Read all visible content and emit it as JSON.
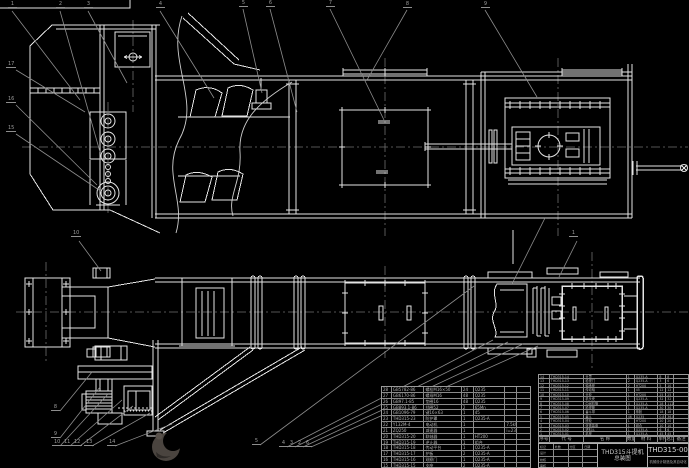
{
  "colors": {
    "background": "#000000",
    "drawing_line": "#e4e4e4",
    "leader_line": "#8d8d8d",
    "centerline": "#6f6f6f",
    "table_text": "#b5b5b5",
    "watermark": "#4a443f"
  },
  "title_block": {
    "title_line1": "THD315斗提机",
    "title_line2": "总装图",
    "drawing_no": "THD315-00",
    "org": "机械设计制造及其自动化",
    "signature_grid": [
      [
        "标记",
        "处数",
        "分区",
        "日期"
      ],
      [
        "设计",
        "",
        "",
        ""
      ],
      [
        "校核",
        "",
        "",
        ""
      ],
      [
        "审核",
        "",
        "",
        ""
      ]
    ]
  },
  "bom_right_header": [
    [
      "序号",
      "代 号",
      "名 称",
      "数量",
      "材 料",
      "单件",
      "总计",
      "备注"
    ]
  ],
  "bom_right_rows": [
    [
      "14",
      "THD315-14",
      "头罩",
      "1",
      "Q235-A",
      "8",
      "8",
      ""
    ],
    [
      "13",
      "THD315-13",
      "检视门",
      "2",
      "Q235-A",
      "3",
      "6",
      ""
    ],
    [
      "12",
      "THD315-12",
      "轴承座",
      "2",
      "HT200",
      "5",
      "10",
      ""
    ],
    [
      "11",
      "THD315-11",
      "传动轴",
      "1",
      "45",
      "12",
      "12",
      ""
    ],
    [
      "10",
      "THD315-10",
      "头轮",
      "1",
      "HT200",
      "25",
      "25",
      ""
    ],
    [
      "9",
      "THD315-09",
      "机头壳",
      "1",
      "Q235-A",
      "32",
      "32",
      ""
    ],
    [
      "8",
      "THD315-08",
      "中间机筒",
      "4",
      "Q235-A",
      "28",
      "112",
      ""
    ],
    [
      "7",
      "THD315-07",
      "检视筒",
      "1",
      "Q235-A",
      "30",
      "30",
      ""
    ],
    [
      "6",
      "THD315-06",
      "畚斗带",
      "1",
      "橡胶",
      "18",
      "18",
      ""
    ],
    [
      "5",
      "THD315-05",
      "畚斗",
      "46",
      "Q235",
      "0.8",
      "36.8",
      ""
    ],
    [
      "4",
      "THD315-04",
      "底轮",
      "1",
      "HT200",
      "20",
      "20",
      ""
    ],
    [
      "3",
      "THD315-03",
      "张紧装置",
      "1",
      "组合",
      "10",
      "10",
      ""
    ],
    [
      "2",
      "THD315-02",
      "进料斗",
      "1",
      "Q235-A",
      "6",
      "6",
      ""
    ],
    [
      "1",
      "THD315-01",
      "机座",
      "1",
      "Q235-A",
      "45",
      "45",
      ""
    ]
  ],
  "bom_left_rows": [
    [
      "28",
      "GB5782-86",
      "螺栓M16×50",
      "24",
      "Q235",
      "",
      ""
    ],
    [
      "27",
      "GB6170-86",
      "螺母M16",
      "48",
      "Q235",
      "",
      ""
    ],
    [
      "26",
      "GB97.1-85",
      "垫圈16",
      "48",
      "Q235",
      "",
      ""
    ],
    [
      "25",
      "GB893.1-86",
      "挡圈52",
      "2",
      "65Mn",
      "",
      ""
    ],
    [
      "24",
      "GB1096-79",
      "键16×63",
      "1",
      "45",
      "",
      ""
    ],
    [
      "23",
      "THD315-23",
      "防护罩",
      "1",
      "Q235-A",
      "",
      ""
    ],
    [
      "22",
      "Y132M-4",
      "电动机",
      "1",
      "",
      "7.5kW",
      ""
    ],
    [
      "21",
      "ZQ250",
      "减速器",
      "1",
      "",
      "i=23.3",
      ""
    ],
    [
      "20",
      "THD315-20",
      "联轴器",
      "1",
      "HT200",
      "",
      ""
    ],
    [
      "19",
      "THD315-19",
      "逆止器",
      "1",
      "组合",
      "",
      ""
    ],
    [
      "18",
      "THD315-18",
      "传动平台",
      "1",
      "Q235-A",
      "",
      ""
    ],
    [
      "17",
      "THD315-17",
      "护板",
      "2",
      "Q235-A",
      "",
      ""
    ],
    [
      "16",
      "THD315-16",
      "观察门",
      "1",
      "Q235-A",
      "",
      ""
    ],
    [
      "15",
      "THD315-15",
      "支座",
      "2",
      "Q235-A",
      "",
      ""
    ]
  ],
  "callouts": [
    {
      "n": "1",
      "x": 8,
      "y": 2
    },
    {
      "n": "2",
      "x": 56,
      "y": 2
    },
    {
      "n": "3",
      "x": 84,
      "y": 2
    },
    {
      "n": "4",
      "x": 156,
      "y": 2
    },
    {
      "n": "5",
      "x": 239,
      "y": 1
    },
    {
      "n": "6",
      "x": 266,
      "y": 1
    },
    {
      "n": "7",
      "x": 326,
      "y": 1
    },
    {
      "n": "8",
      "x": 403,
      "y": 2
    },
    {
      "n": "9",
      "x": 481,
      "y": 2
    },
    {
      "n": "17",
      "x": 6,
      "y": 62
    },
    {
      "n": "16",
      "x": 6,
      "y": 97
    },
    {
      "n": "15",
      "x": 6,
      "y": 126
    },
    {
      "n": "10",
      "x": 71,
      "y": 231
    },
    {
      "n": "1",
      "x": 569,
      "y": 231
    },
    {
      "n": "8",
      "x": 51,
      "y": 405
    },
    {
      "n": "9",
      "x": 51,
      "y": 432
    },
    {
      "n": "10",
      "x": 52,
      "y": 440
    },
    {
      "n": "11",
      "x": 62,
      "y": 440
    },
    {
      "n": "12",
      "x": 72,
      "y": 440
    },
    {
      "n": "13",
      "x": 84,
      "y": 440
    },
    {
      "n": "14",
      "x": 107,
      "y": 440
    },
    {
      "n": "5",
      "x": 252,
      "y": 439
    },
    {
      "n": "4",
      "x": 279,
      "y": 441
    },
    {
      "n": "3",
      "x": 287,
      "y": 441
    },
    {
      "n": "2",
      "x": 295,
      "y": 441
    },
    {
      "n": "6",
      "x": 303,
      "y": 441
    }
  ]
}
